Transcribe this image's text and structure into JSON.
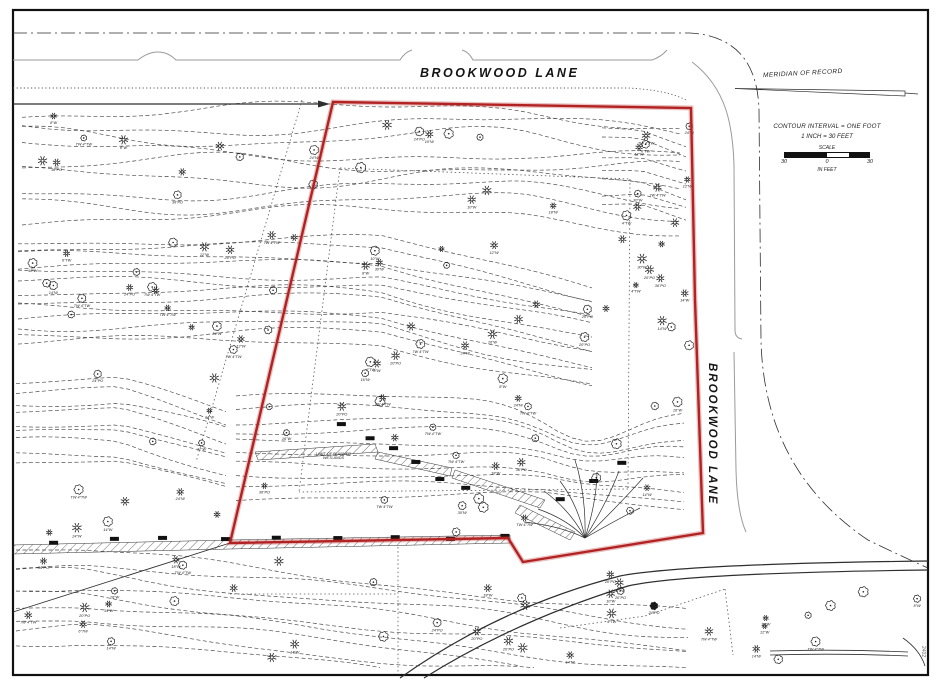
{
  "drawing": {
    "street_top": "BROOKWOOD LANE",
    "street_right": "BROOKWOOD LANE",
    "meridian_label": "MERIDIAN OF RECORD",
    "wetlands_note_line1": "LIMIT OF PLANNED",
    "wetlands_note_line2": "WETLANDS",
    "corner_note": "2402",
    "legend": {
      "line1": "CONTOUR INTERVAL = ONE FOOT",
      "line2": "1 INCH = 30 FEET",
      "scale_title": "SCALE",
      "left_val": "30",
      "mid_val": "0",
      "right_val": "30",
      "units": "IN FEET"
    }
  },
  "colors": {
    "boundary_red": "#b22222",
    "boundary_glow": "rgba(178,34,34,0.28)",
    "line_dark": "#2f2f2f",
    "contour": "#454545",
    "curb_gray": "#9a9a9a",
    "dotted": "#5a5a5a",
    "border": "#111111",
    "background": "#ffffff",
    "tree_line": "#222222",
    "tree_fill_dark": "#1a1a1a"
  },
  "boundary_points": [
    [
      333,
      102
    ],
    [
      691,
      108
    ],
    [
      695,
      300
    ],
    [
      703,
      533
    ],
    [
      523,
      562
    ],
    [
      508,
      538
    ],
    [
      230,
      543
    ]
  ],
  "seed": 12,
  "contour_bands": [
    {
      "x0": 22,
      "x1": 692,
      "y0": 112,
      "count": 9,
      "spacing": 13,
      "amp": 9,
      "slope": 0.06,
      "slopeFrom": 520
    },
    {
      "x0": 18,
      "x1": 598,
      "y0": 240,
      "count": 13,
      "spacing": 8.5,
      "amp": 5,
      "slope": 0.22,
      "slopeFrom": 380
    },
    {
      "x0": 236,
      "x1": 694,
      "y0": 398,
      "count": 10,
      "spacing": 11,
      "amp": 4,
      "slope": 0.1,
      "slopeFrom": 545,
      "ravine": true
    },
    {
      "x0": 16,
      "x1": 694,
      "y0": 552,
      "count": 9,
      "spacing": 11,
      "amp": 5,
      "slope": 0.1,
      "slopeFrom": 80
    },
    {
      "x0": 16,
      "x1": 228,
      "y0": 382,
      "count": 9,
      "spacing": 10,
      "amp": 4,
      "slope": 0.28,
      "slopeFrom": 120
    },
    {
      "x0": 602,
      "x1": 694,
      "y0": 128,
      "count": 7,
      "spacing": 13,
      "amp": 3,
      "slope": 0.35,
      "slopeFrom": 640
    }
  ],
  "tree_regions": [
    {
      "x": 30,
      "y": 112,
      "w": 640,
      "h": 62,
      "n": 16
    },
    {
      "x": 25,
      "y": 180,
      "w": 300,
      "h": 212,
      "n": 26
    },
    {
      "x": 350,
      "y": 188,
      "w": 330,
      "h": 198,
      "n": 30
    },
    {
      "x": 240,
      "y": 396,
      "w": 440,
      "h": 140,
      "n": 26
    },
    {
      "x": 20,
      "y": 402,
      "w": 200,
      "h": 138,
      "n": 10
    },
    {
      "x": 25,
      "y": 552,
      "w": 660,
      "h": 108,
      "n": 30
    },
    {
      "x": 706,
      "y": 588,
      "w": 212,
      "h": 76,
      "n": 10
    },
    {
      "x": 618,
      "y": 122,
      "w": 72,
      "h": 272,
      "n": 12
    }
  ],
  "tree_labels": [
    "12\"W",
    "24\"W",
    "18\"W",
    "14\"W",
    "8\"W",
    "20\"PO",
    "10\"W",
    "36\"PO",
    "16\"W",
    "6\"TW",
    "4\"TW",
    "30\"W",
    "TW 4\"TW",
    "24\"PO",
    "7W 4\"TW"
  ],
  "wall_runs": [
    {
      "x0": 55,
      "y0": 541,
      "x1": 505,
      "y1": 536,
      "n": 9
    },
    {
      "x0": 342,
      "y0": 424,
      "x1": 468,
      "y1": 490,
      "n": 6
    },
    {
      "x0": 556,
      "y0": 500,
      "x1": 622,
      "y1": 460,
      "n": 3
    }
  ]
}
